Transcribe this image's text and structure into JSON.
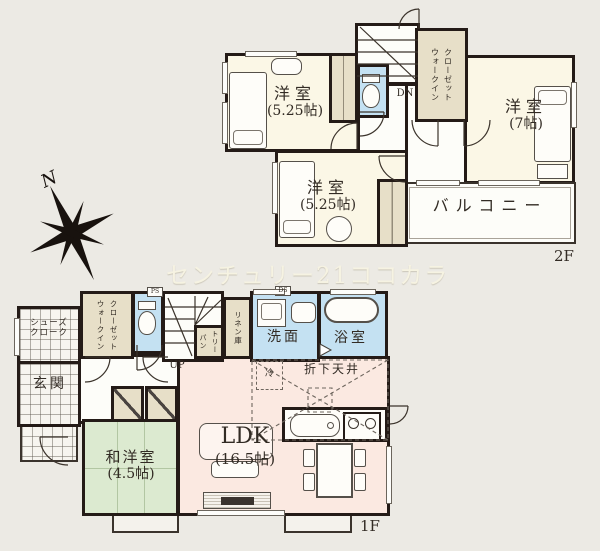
{
  "colors": {
    "background": "#eceae4",
    "wall": "#241b17",
    "room_cream": "#fbf7e6",
    "closet_beige": "#e7dfc8",
    "wet_area_blue": "#c4e1f2",
    "ldk_pink": "#fbe9e1",
    "tatami_green": "#dcead0"
  },
  "compass": {
    "label": "N"
  },
  "watermark": {
    "text": "センチュリー21ココカラ"
  },
  "floor2": {
    "floor_label": "2F",
    "bedroom1": {
      "name": "洋室",
      "size": "(5.25帖)"
    },
    "bedroom2": {
      "name": "洋室",
      "size": "(7帖)"
    },
    "bedroom3": {
      "name": "洋室",
      "size": "(5.25帖)"
    },
    "walkin_closet": {
      "line1": "ウォークイン",
      "line2": "クローゼット"
    },
    "balcony": {
      "name": "バルコニー"
    },
    "stairs": {
      "label": "DN"
    }
  },
  "floor1": {
    "floor_label": "1F",
    "shoes_closet": {
      "line1": "シューズ",
      "line2": "クローク"
    },
    "entrance": {
      "name": "玄関"
    },
    "walkin_closet": {
      "line1": "ウォークイン",
      "line2": "クローゼット"
    },
    "pantry": {
      "line1": "パン",
      "line2": "トリー"
    },
    "linen": {
      "name": "リネン庫"
    },
    "washroom": {
      "name": "洗面"
    },
    "bathroom": {
      "name": "浴室"
    },
    "ldk": {
      "name": "LDK",
      "size": "(16.5帖)"
    },
    "tatami_room": {
      "name": "和洋室",
      "size": "(4.5帖)"
    },
    "lowered_ceiling": {
      "name": "折下天井"
    },
    "refrigerator": {
      "label": "冷"
    },
    "stairs": {
      "label": "UP"
    },
    "pipe_space": {
      "label": "PS"
    },
    "duct_space": {
      "label": "DS"
    }
  }
}
